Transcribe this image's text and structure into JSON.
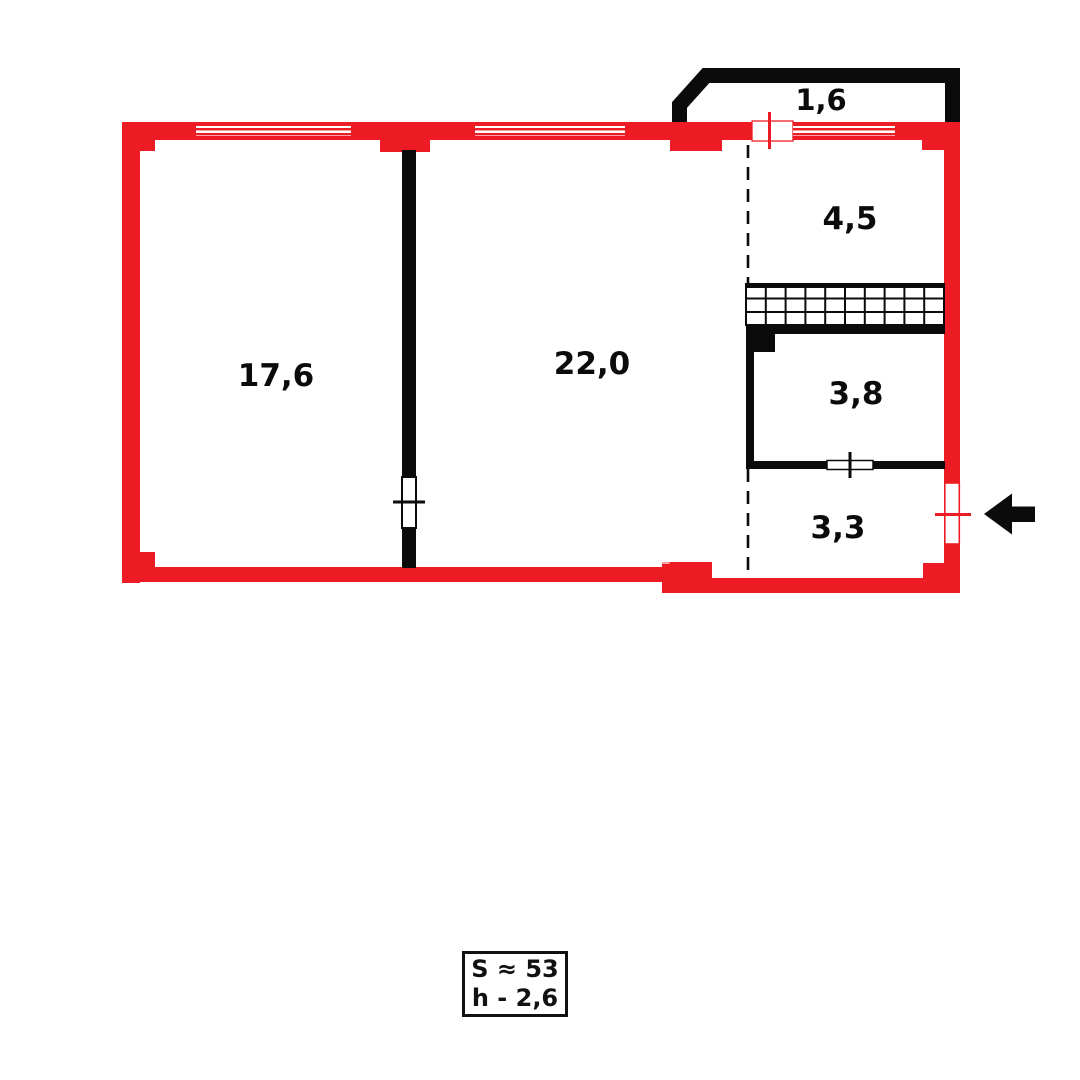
{
  "plan": {
    "rooms": [
      {
        "id": "living-room",
        "area_label": "17,6"
      },
      {
        "id": "hall-room",
        "area_label": "22,0"
      },
      {
        "id": "balcony",
        "area_label": "1,6"
      },
      {
        "id": "kitchen",
        "area_label": "4,5"
      },
      {
        "id": "bathroom",
        "area_label": "3,8"
      },
      {
        "id": "entry",
        "area_label": "3,3"
      }
    ],
    "info_box": {
      "total_area": "S ≈ 53",
      "ceiling_height": "h - 2,6"
    },
    "watermark": {
      "text": "kn.kz",
      "left": "kn",
      "right": "kz"
    },
    "icons": {
      "entrance_arrow": "left-arrow"
    },
    "colors": {
      "wall_red": "#ED1C24",
      "wall_black": "#0B0B0B",
      "background": "#FFFFFF"
    }
  }
}
